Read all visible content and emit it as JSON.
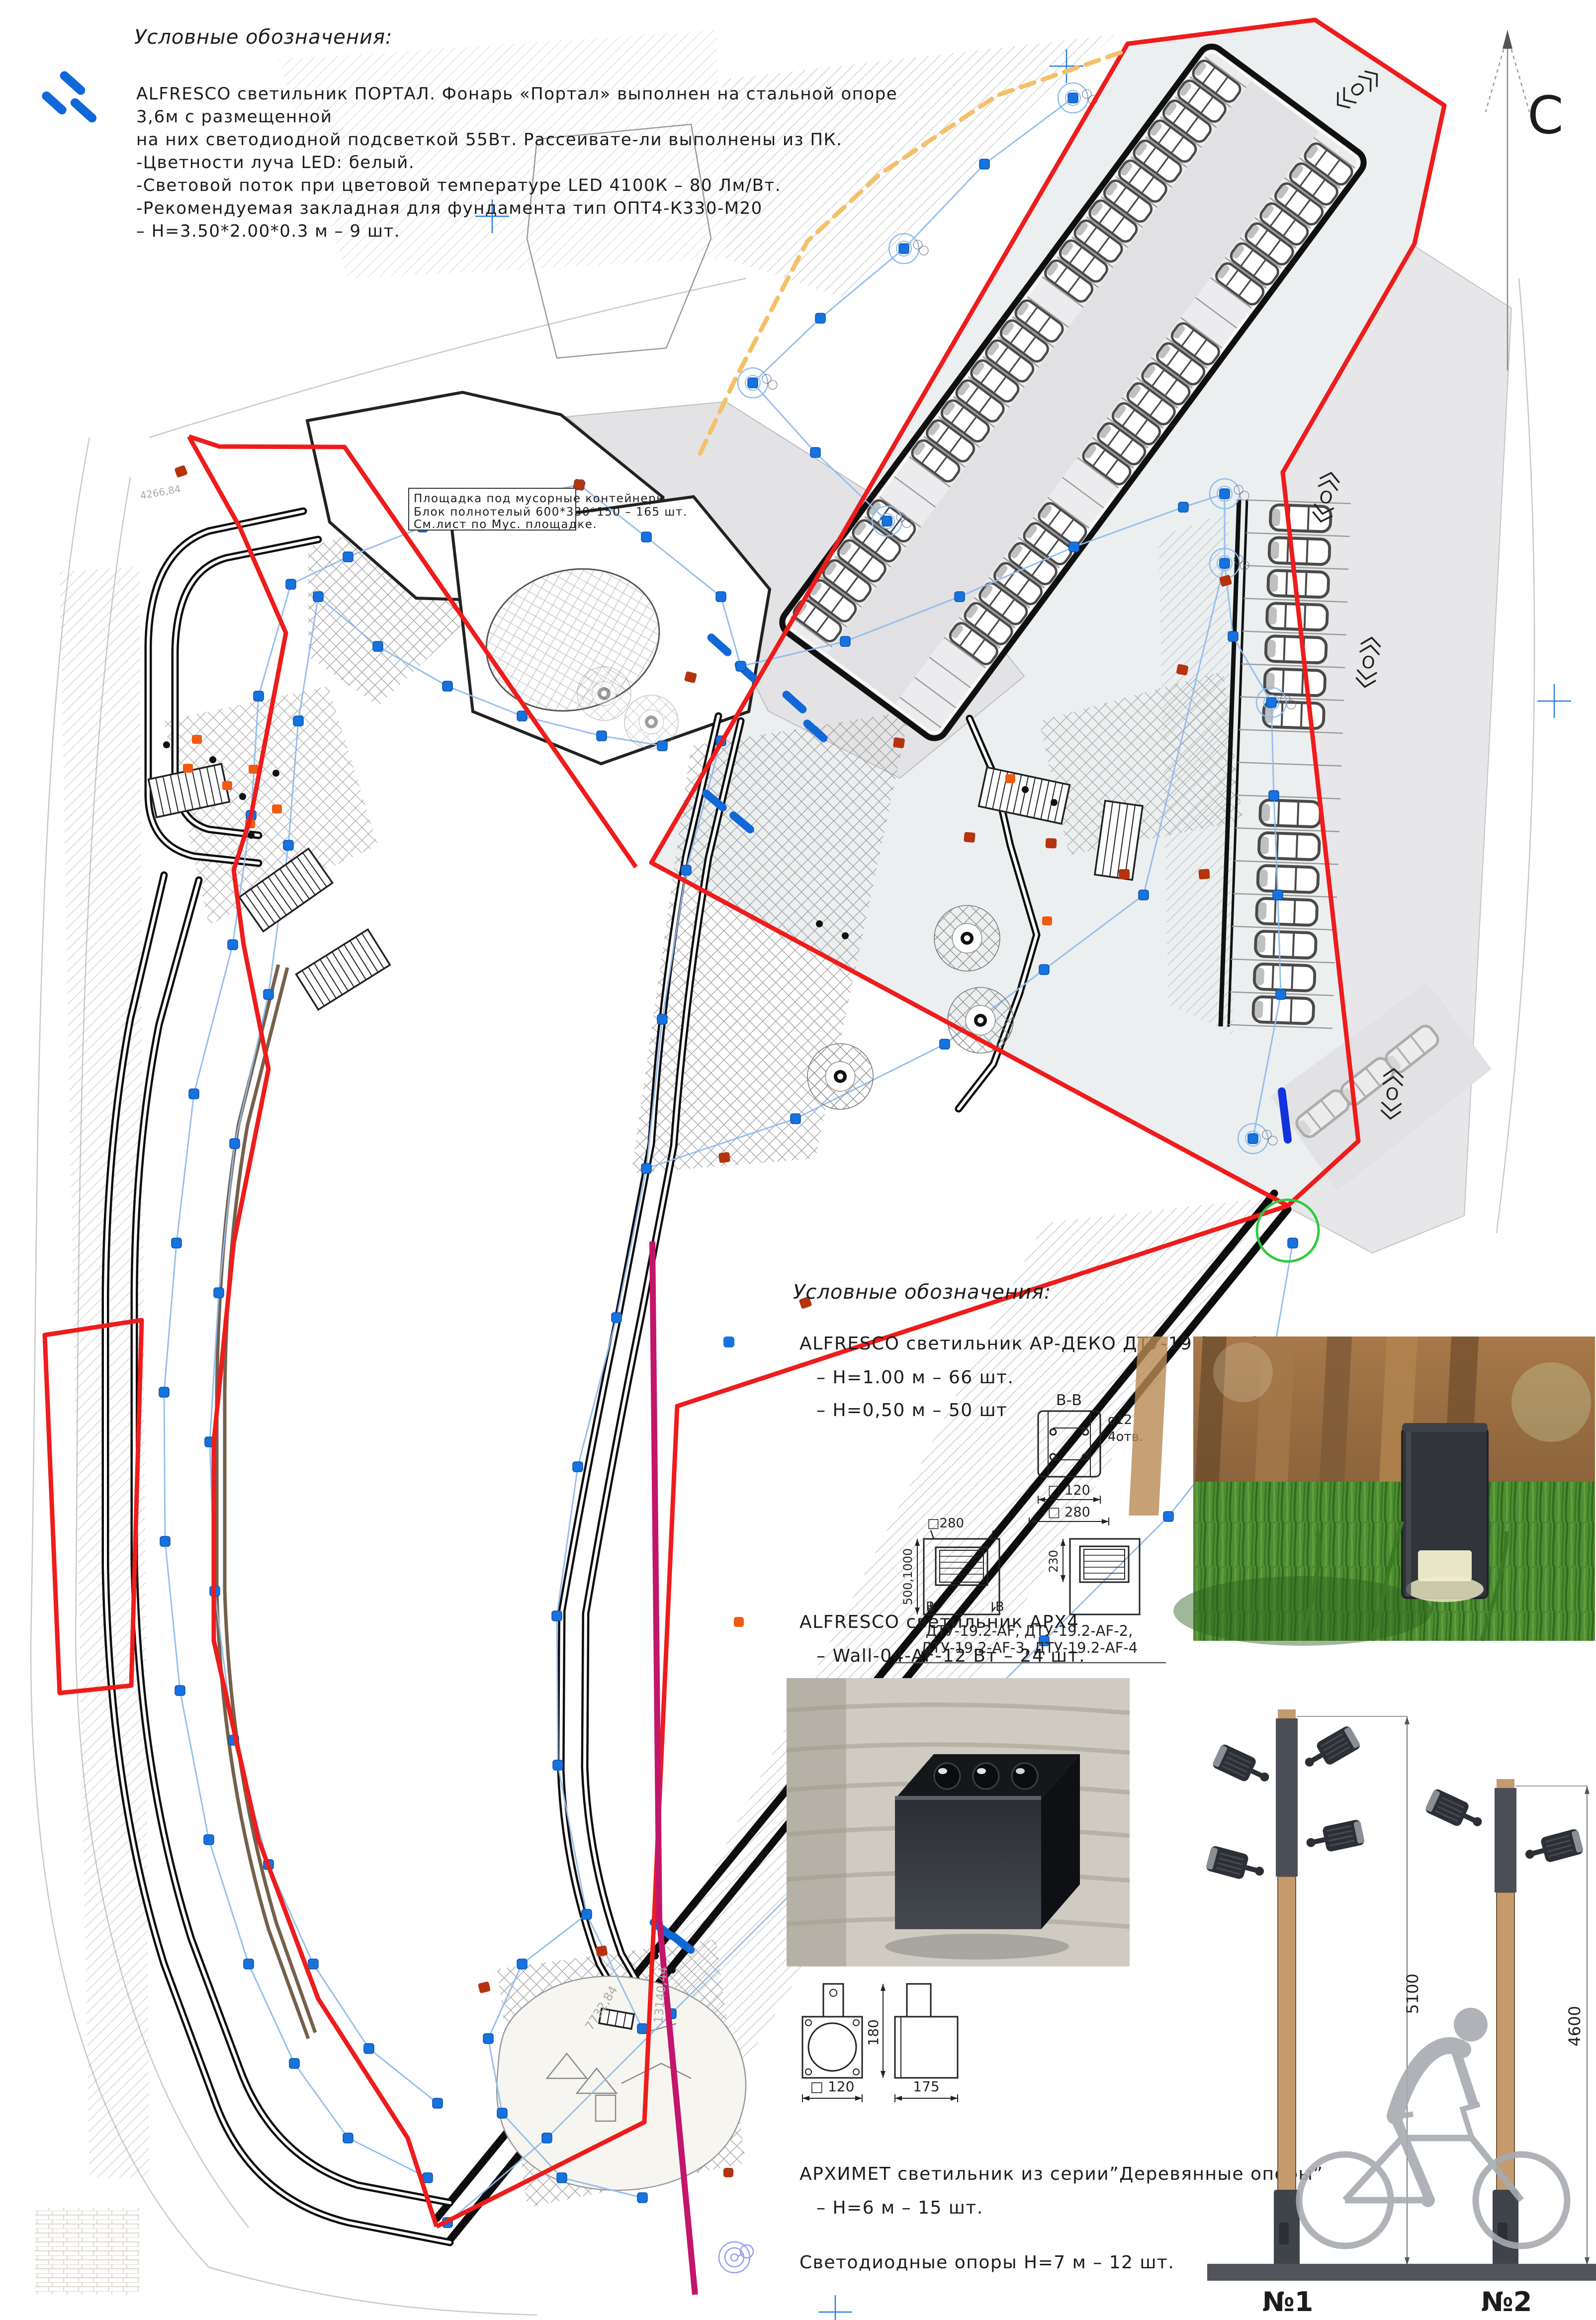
{
  "palette": {
    "portal_blue": "#1168d9",
    "marker_blue": "#1573e0",
    "cable_blue": "#8fbcec",
    "boundary_red": "#ee1c1c",
    "magenta": "#c2156b",
    "orange_dashed": "#f4c06a",
    "marker_orange": "#f25a10",
    "marker_brown": "#b5330e",
    "led_violet": "#9b9bf0",
    "road_gray": "#e7e7e9",
    "ground_dark": "#51555b",
    "wood": "#c59a6d",
    "green_circle": "#2ecc40"
  },
  "north_arrow": {
    "label": "С"
  },
  "legend_top": {
    "title": "Условные обозначения:",
    "portal": {
      "lines": [
        "ALFRESCO светильник ПОРТАЛ. Фонарь «Портал» выполнен на стальной опоре",
        "3,6м с размещенной",
        "на них светодиодной подсветкой 55Вт. Рассеивате-ли выполнены из ПК.",
        "-Цветности луча LED: белый.",
        "-Световой поток при цветовой температуре LED 4100К – 80 Лм/Вт.",
        "-Рекомендуемая закладная для фундамента тип ОПТ4-К330-М20",
        "–  Н=3.50*2.00*0.3 м  –  9 шт."
      ]
    }
  },
  "plan": {
    "note_box": {
      "line1": "Площадка под мусорные контейнеры",
      "line2": "Блок полнотелый 600*330*150 – 165 шт.",
      "line3": "См.лист по Мус. площадке."
    },
    "road_symbol_letter": "О",
    "survey_numbers": {
      "n1": "4266,84",
      "n2": "7732,84",
      "n3": "13140,44"
    }
  },
  "legend_right": {
    "title": "Условные обозначения:",
    "ardeko": {
      "title": "ALFRESCO светильник АР-ДЕКО ДТУ-19.2-AF-3:",
      "qty1": "–  Н=1.00 м – 66 шт.",
      "qty2": "–  Н=0,50 м – 50 шт"
    },
    "section": {
      "label": "В-В",
      "holes_d": "ø12",
      "holes_n": "4отв.",
      "dim_inner": "□ 120",
      "dim_outer": "□ 280"
    },
    "elevation": {
      "dim_top": "□280",
      "dim_h_left": "500,1000",
      "dim_h_right": "230",
      "mark_left": "В",
      "mark_right": "В",
      "caption1": "ДТУ-19.2-AF, ДТУ-19.2-AF-2,",
      "caption2": "ДТУ-19.2-AF-3, ДТУ-19.2-AF-4"
    },
    "arx4": {
      "title": "ALFRESCO светильник АРХ4",
      "qty": "–      Wall-04-AF-12 Вт – 24 шт."
    },
    "wall_dims": {
      "front": "□ 120",
      "height": "180",
      "side": "175"
    },
    "arhimet": {
      "title": "АРХИМЕТ светильник из серии”Деревянные опоры”",
      "qty": "– Н=6 м – 15 шт."
    },
    "led": {
      "title": "Светодиодные опоры Н=7 м – 12 шт."
    }
  },
  "poles": {
    "p1": {
      "dim": "5100",
      "label": "№1"
    },
    "p2": {
      "dim": "4600",
      "label": "№2"
    }
  }
}
